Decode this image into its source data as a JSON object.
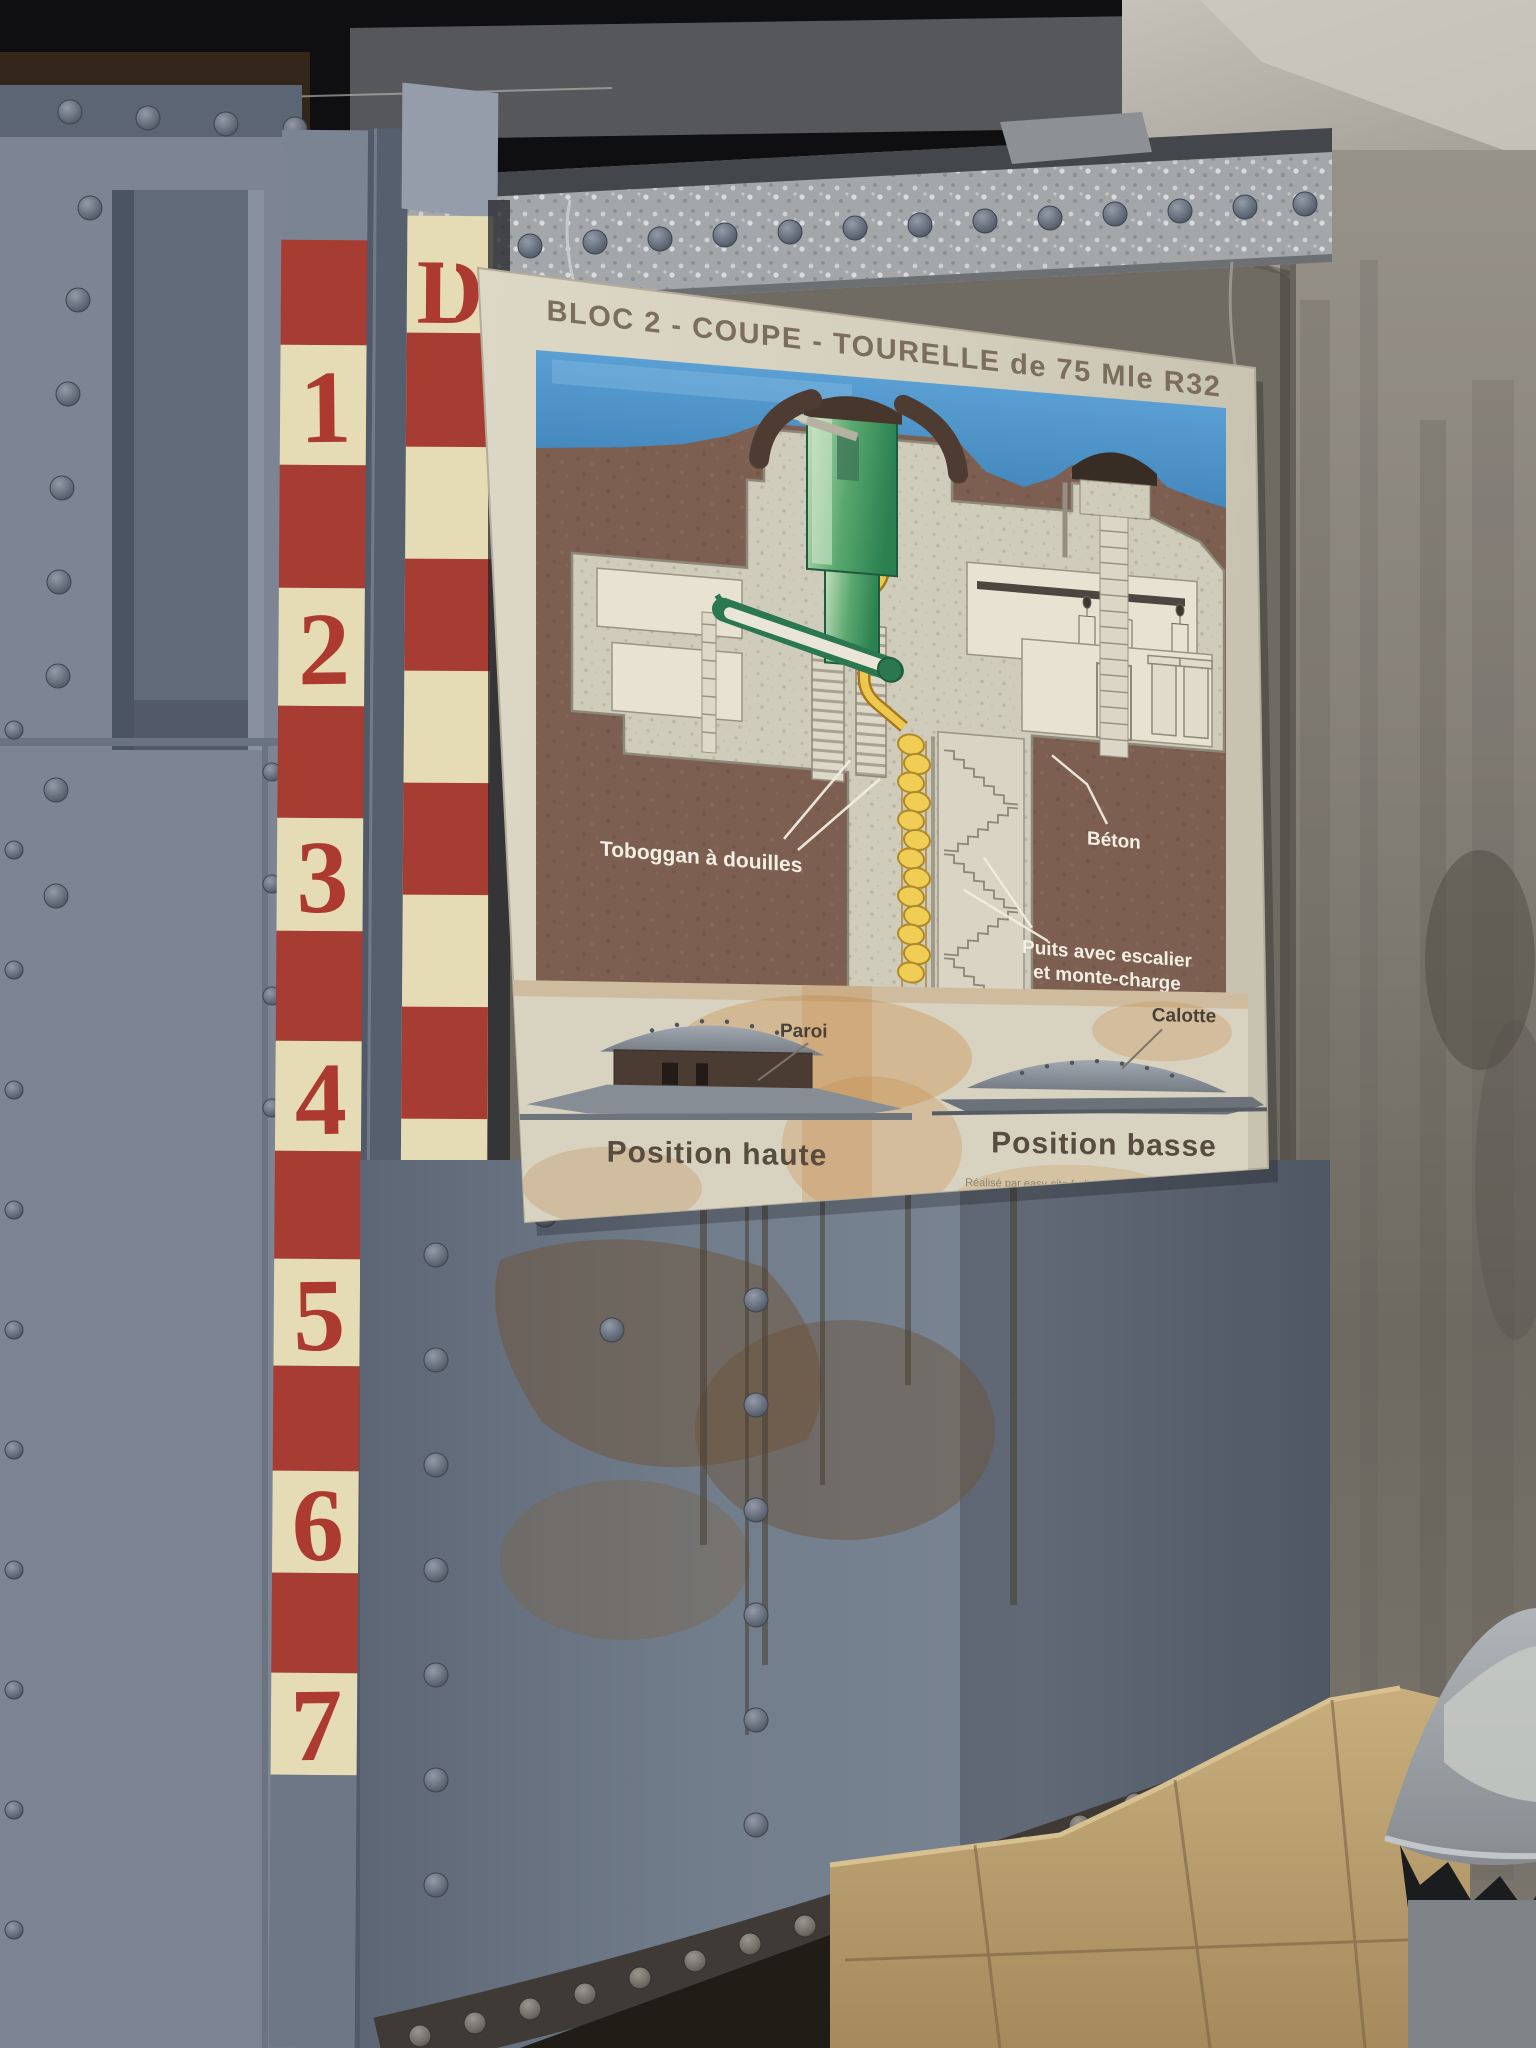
{
  "poster": {
    "title": "BLOC 2 - COUPE - TOURELLE de 75 Mle R32",
    "labels": {
      "toboggan": "Toboggan à douilles",
      "beton": "Béton",
      "puits_line1": "Puits avec escalier",
      "puits_line2": "et monte-charge",
      "paroi": "Paroi",
      "calotte": "Calotte"
    },
    "captions": {
      "haute": "Position haute",
      "basse": "Position basse"
    },
    "credit": "Réalisé par easy-site.fr d'après un plan de Mr. F. Lish"
  },
  "gauge": {
    "top_mark": "D",
    "numbers": [
      "1",
      "2",
      "3",
      "4",
      "5",
      "6",
      "7"
    ]
  },
  "colors": {
    "stripe_red": "#a63c32",
    "stripe_cream": "#e5dbb4",
    "stencil_red": "#ad3a30",
    "paper": "#d8d2c0",
    "sky_blue": "#4e95cc",
    "earth_brown": "#7c5f50",
    "turret_green": "#2e8a55",
    "chute_yellow": "#edc84e",
    "metal_blue_gray": "#7d8595",
    "concrete_wall": "#8e8a82",
    "stone_tan": "#c3a878"
  }
}
